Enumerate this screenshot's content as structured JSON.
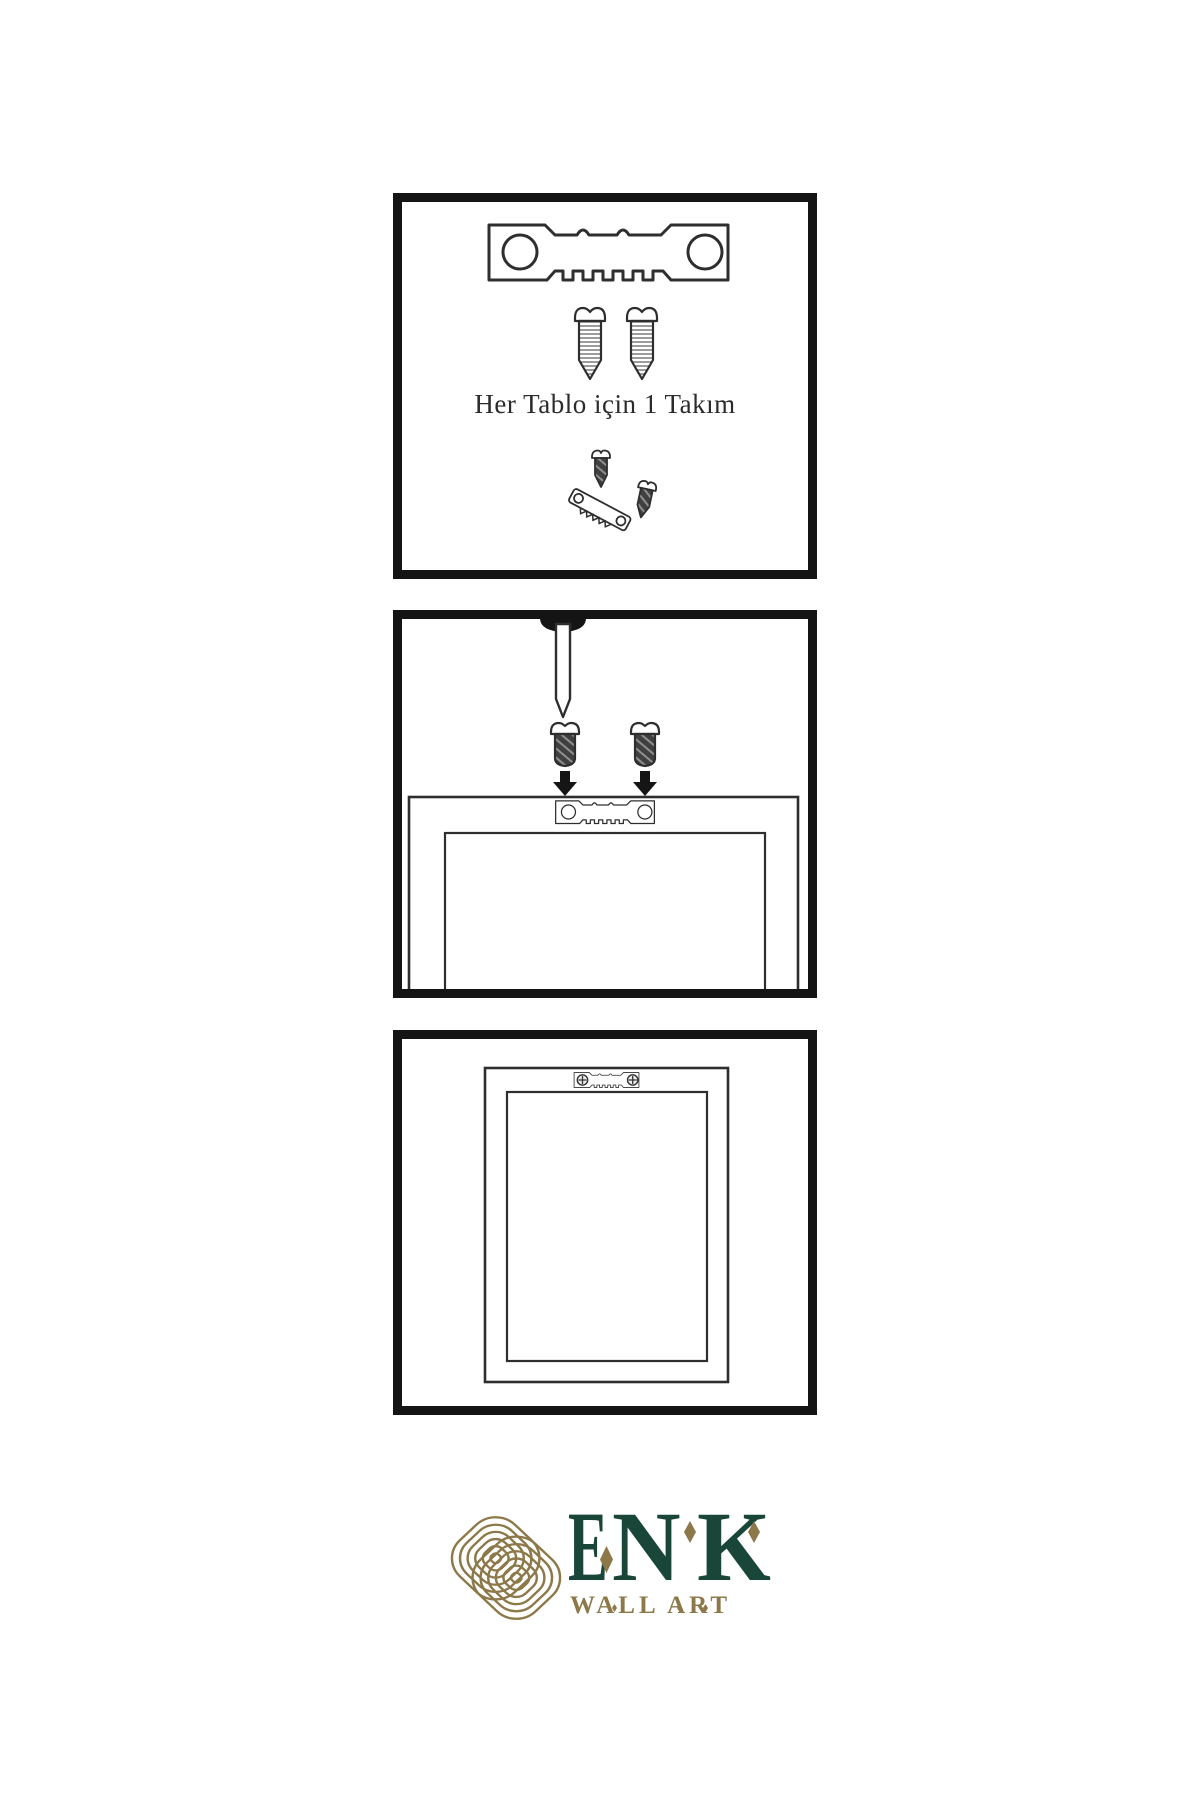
{
  "colors": {
    "ink": "#151515",
    "outline": "#2e2e2e",
    "panel_border": "#141414",
    "screw_dark": "#404040",
    "screw_stripe": "#8f8f8f",
    "thread_stripe": "#5a5a5a",
    "brand_green": "#1a463a",
    "brand_gold": "#8c7848",
    "caption_text": "#2b2b2b",
    "background": "#ffffff"
  },
  "steps": [
    {
      "name": "kit-contents",
      "caption": "Her Tablo için 1 Takım",
      "icons": [
        "sawtooth-hanger-icon",
        "screw-icon",
        "screw-icon",
        "screw-icon",
        "mini-sawtooth-hanger-icon",
        "screw-icon"
      ]
    },
    {
      "name": "attach-hanger-to-frame",
      "icons": [
        "nail-icon",
        "screw-icon",
        "screw-icon",
        "down-arrow-icon",
        "down-arrow-icon",
        "sawtooth-hanger-icon",
        "frame-back-icon"
      ]
    },
    {
      "name": "hang-frame-on-wall",
      "icons": [
        "sawtooth-hanger-mounted-icon",
        "phillips-screw-head-icon",
        "phillips-screw-head-icon",
        "framed-picture-back-icon"
      ]
    }
  ],
  "brand": {
    "name": "ENK",
    "letters": [
      "E",
      "N",
      "K"
    ],
    "tagline": "WALL ART"
  }
}
